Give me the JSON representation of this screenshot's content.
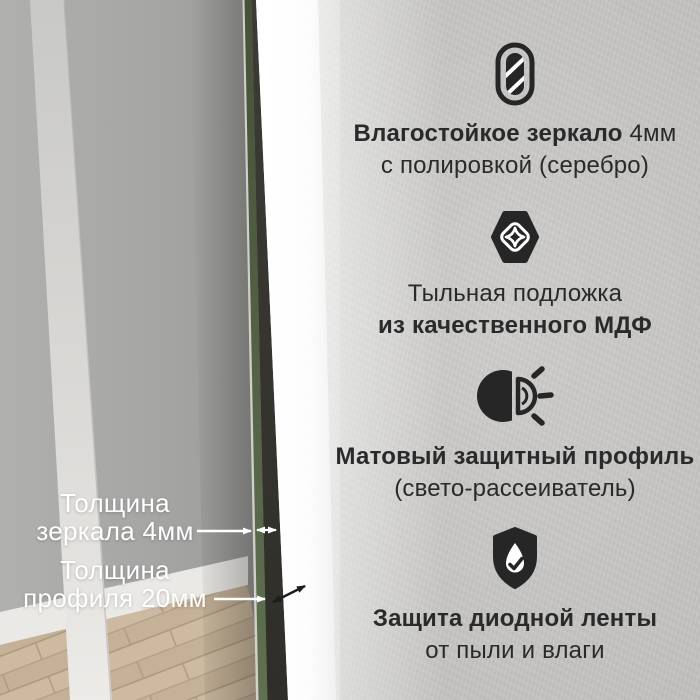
{
  "colors": {
    "background": "#c9c8c6",
    "ink": "#262626",
    "feature_text": "#2a2a2a",
    "callout_text": "#ffffff",
    "glass_edge_green": "#55664a",
    "profile_dark": "#34332d",
    "led_glow": "#ffffff",
    "wood_floor": "#cdbaa0"
  },
  "features": [
    {
      "icon": "mirror-icon",
      "l1b": "Влагостойкое зеркало",
      "l1r": " 4мм",
      "l2b": "",
      "l2r": "с полировкой (серебро)"
    },
    {
      "icon": "mdf-board-icon",
      "l1b": "",
      "l1r": "Тыльная подложка",
      "l2b": "из качественного МДФ",
      "l2r": ""
    },
    {
      "icon": "light-diffuser-icon",
      "l1b": "Матовый защитный профиль",
      "l1r": "",
      "l2b": "",
      "l2r": "(свето-рассеиватель)"
    },
    {
      "icon": "shield-check-icon",
      "l1b": "Защита диодной ленты",
      "l1r": "",
      "l2b": "",
      "l2r": "от пыли и влаги"
    }
  ],
  "callouts": [
    {
      "line1": "Толщина",
      "line2": "зеркала 4мм"
    },
    {
      "line1": "Толщина",
      "line2": "профиля 20мм"
    }
  ]
}
